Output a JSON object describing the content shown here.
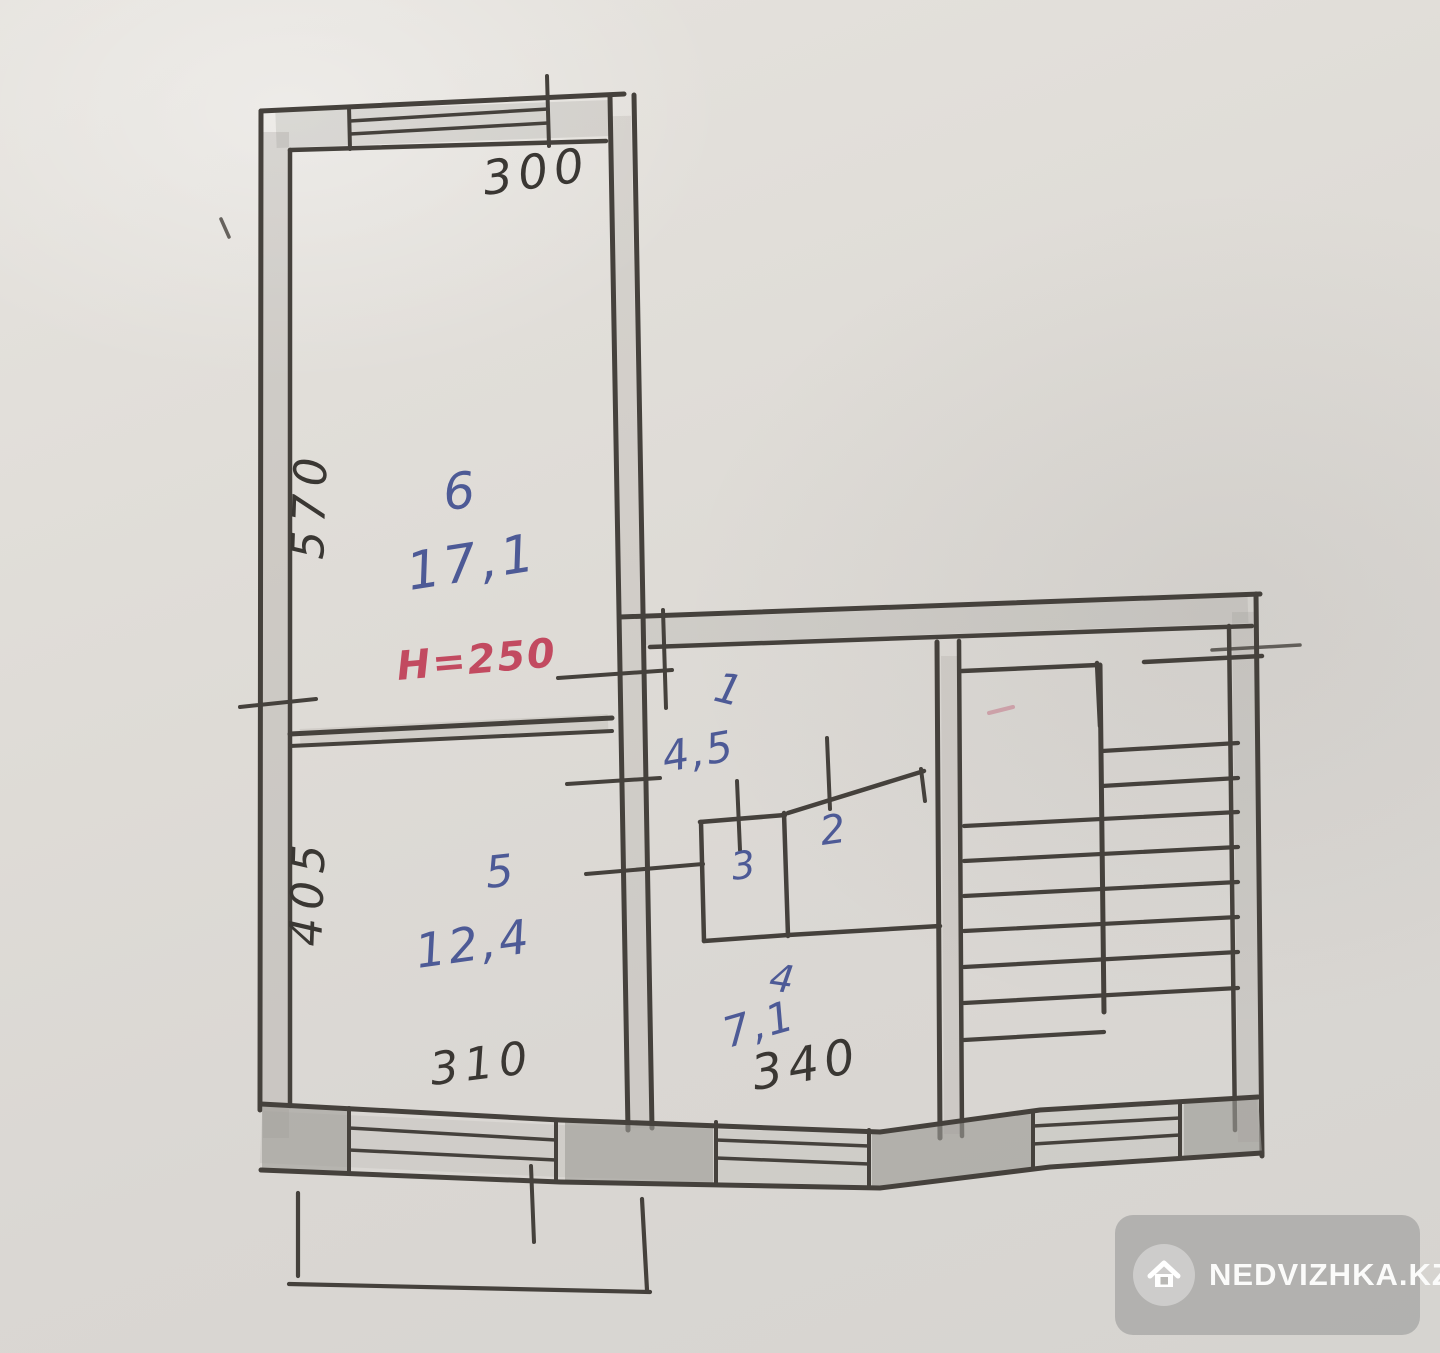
{
  "plan": {
    "height_note": "Н=250",
    "dims": {
      "top": "300",
      "left_upper": "570",
      "left_lower": "405",
      "bottom_left": "310",
      "bottom_kitchen": "340"
    },
    "rooms": {
      "room6": {
        "number": "6",
        "area": "17,1"
      },
      "room5": {
        "number": "5",
        "area": "12,4"
      },
      "hall": {
        "number": "1",
        "area": "4,5"
      },
      "bath": {
        "number": "2"
      },
      "wc": {
        "number": "3"
      },
      "kitchen": {
        "number": "4",
        "area": "7,1"
      }
    },
    "colors": {
      "ink_blue": "#4d5a96",
      "ink_red": "#c24a60",
      "pencil": "#3a3733",
      "wall_shade": "#9b9892"
    }
  },
  "watermark": {
    "brand": "NEDVIZHKA.KZ",
    "icon": "house-icon"
  }
}
